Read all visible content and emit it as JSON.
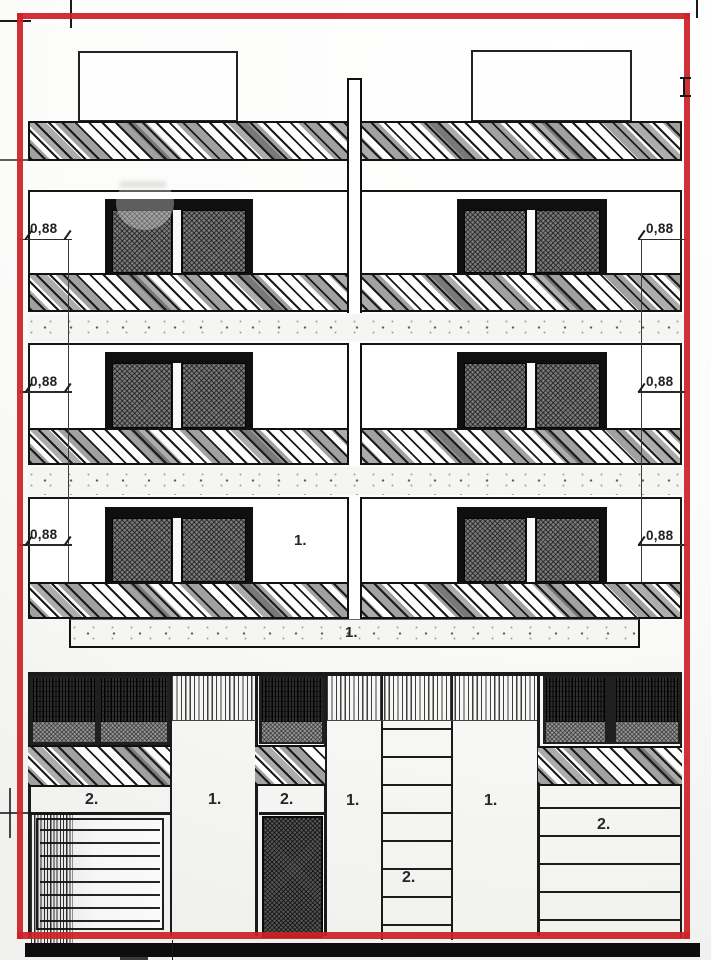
{
  "drawing": {
    "kind": "building-front-elevation",
    "colors": {
      "highlight_border": "#cc2127",
      "ink": "#1a1a1a",
      "paper": "#fbfbfa"
    }
  },
  "dimension_labels": {
    "floor3_left": "0,88",
    "floor3_right": "0,88",
    "floor2_left": "0,88",
    "floor2_right": "0,88",
    "floor1_left": "0,88",
    "floor1_right": "0,88"
  },
  "floor_labels": {
    "floor1_unit": "1.",
    "parapet_band": "1."
  },
  "ground_floor_labels": {
    "garage_left": "2.",
    "pillar_left": "1.",
    "entrance_door": "2.",
    "pillar_mid_left": "1.",
    "staircase": "2.",
    "pillar_mid_right": "1.",
    "garage_right": "2."
  }
}
